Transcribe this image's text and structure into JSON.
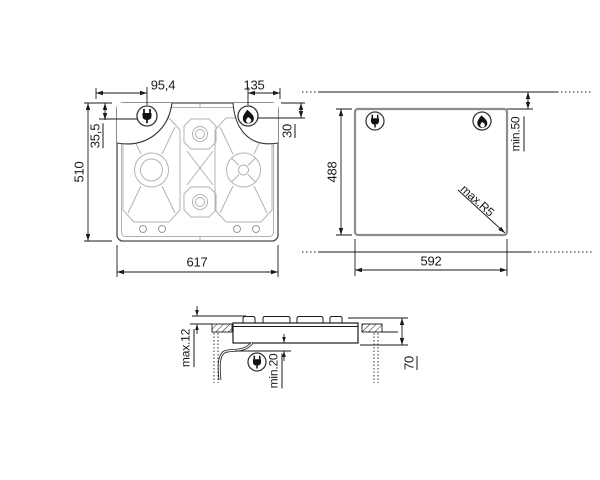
{
  "title": "Built-in gas hob installation drawing",
  "top_view": {
    "width": "617",
    "depth": "510",
    "electric_offset_x": "95,4",
    "electric_offset_y": "35,5",
    "gas_offset_x": "135",
    "gas_offset_y": "30"
  },
  "cutout_view": {
    "width": "592",
    "depth": "488",
    "rear_clearance": "min.50",
    "corner_radius": "max.R5"
  },
  "side_view": {
    "height_above_worktop": "max.12",
    "clearance_below": "min.20",
    "depth_below": "70"
  },
  "icons": {
    "plug": "plug-icon",
    "flame": "flame-icon"
  },
  "colors": {
    "line": "#1a1a1a",
    "pattern": "#b3b3b3",
    "hob_outline": "#4d4d4d",
    "cutout_stroke": "#8c8c8c",
    "background": "#ffffff"
  }
}
